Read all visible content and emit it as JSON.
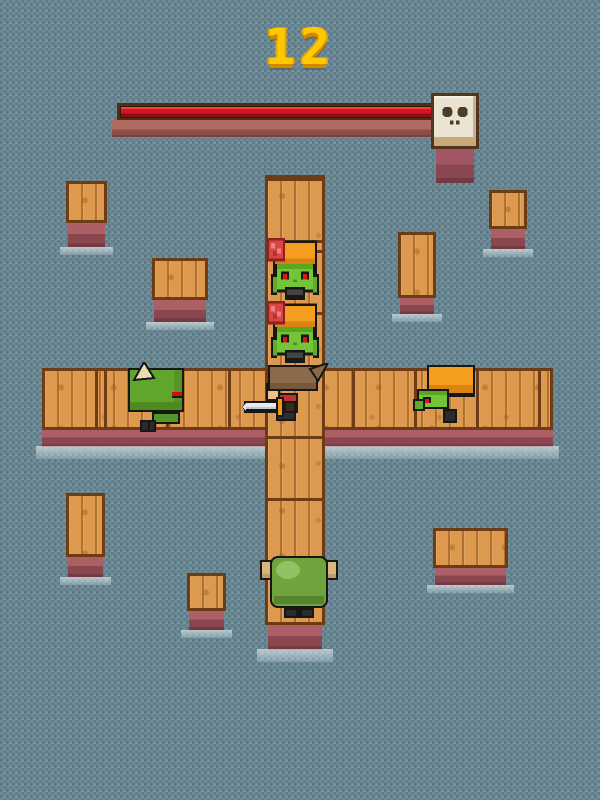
{
  "meta": {
    "app": "pixel-arena-game",
    "canvas": {
      "width": 600,
      "height": 800
    }
  },
  "hud": {
    "score": "12",
    "boss_bar": {
      "fill_percent": 100,
      "fill_color": "#d01622",
      "icon": "skull"
    }
  },
  "palette": {
    "background": "#6b8892",
    "background_dark": "#617e8a",
    "background_light": "#72909b",
    "score_yellow": "#ffc800",
    "health_red": "#d01622",
    "wood": "#dd9a4e",
    "wood_border": "#6d3b14",
    "pier_base": "#a25663",
    "foam": "#e8f0f3",
    "zombie_green": "#74c437",
    "zombie_hair_orange": "#f59d1e",
    "enemy_eye_red": "#e01616",
    "brain_red": "#d84545",
    "monster_green": "#61a62c",
    "horn_cream": "#ecdcb2",
    "player_hair_brown": "#8a6a4a",
    "player_shirt_red": "#c1302a",
    "player_skin": "#eec08e",
    "sword_blade": "#e9eaf0",
    "sword_guard_orange": "#e8951c",
    "blob_green": "#6fa33c",
    "blob_arm_tan": "#d9b67c",
    "skull_tile_cream": "#ebe3d1"
  },
  "entities": [
    {
      "name": "enemy-zombie-top-1",
      "type": "zombie",
      "facing": "down",
      "features": [
        "orange-hair",
        "red-eyes",
        "exposed-brain"
      ]
    },
    {
      "name": "enemy-zombie-top-2",
      "type": "zombie",
      "facing": "down",
      "features": [
        "orange-hair",
        "red-eyes",
        "exposed-brain"
      ]
    },
    {
      "name": "enemy-horned-monster",
      "type": "horned-monster",
      "facing": "right",
      "features": [
        "cream-horn",
        "red-mouth"
      ]
    },
    {
      "name": "enemy-zombie-right",
      "type": "zombie",
      "facing": "left",
      "features": [
        "orange-hair",
        "red-eye"
      ]
    },
    {
      "name": "player-hero",
      "type": "player",
      "facing": "left",
      "weapon": "sword",
      "features": [
        "brown-hair",
        "red-shirt"
      ]
    },
    {
      "name": "enemy-blob-bottom",
      "type": "blob",
      "facing": "up",
      "features": [
        "green-body",
        "tan-arms"
      ]
    }
  ],
  "platforms": [
    {
      "x": 66,
      "y": 181,
      "w": 41,
      "h": 42,
      "base": 24
    },
    {
      "x": 152,
      "y": 258,
      "w": 56,
      "h": 42,
      "base": 22
    },
    {
      "x": 398,
      "y": 232,
      "w": 38,
      "h": 66,
      "base": 16
    },
    {
      "x": 489,
      "y": 190,
      "w": 38,
      "h": 39,
      "base": 20
    },
    {
      "x": 66,
      "y": 493,
      "w": 39,
      "h": 64,
      "base": 20
    },
    {
      "x": 187,
      "y": 573,
      "w": 39,
      "h": 38,
      "base": 19
    },
    {
      "x": 433,
      "y": 528,
      "w": 75,
      "h": 40,
      "base": 17
    }
  ]
}
